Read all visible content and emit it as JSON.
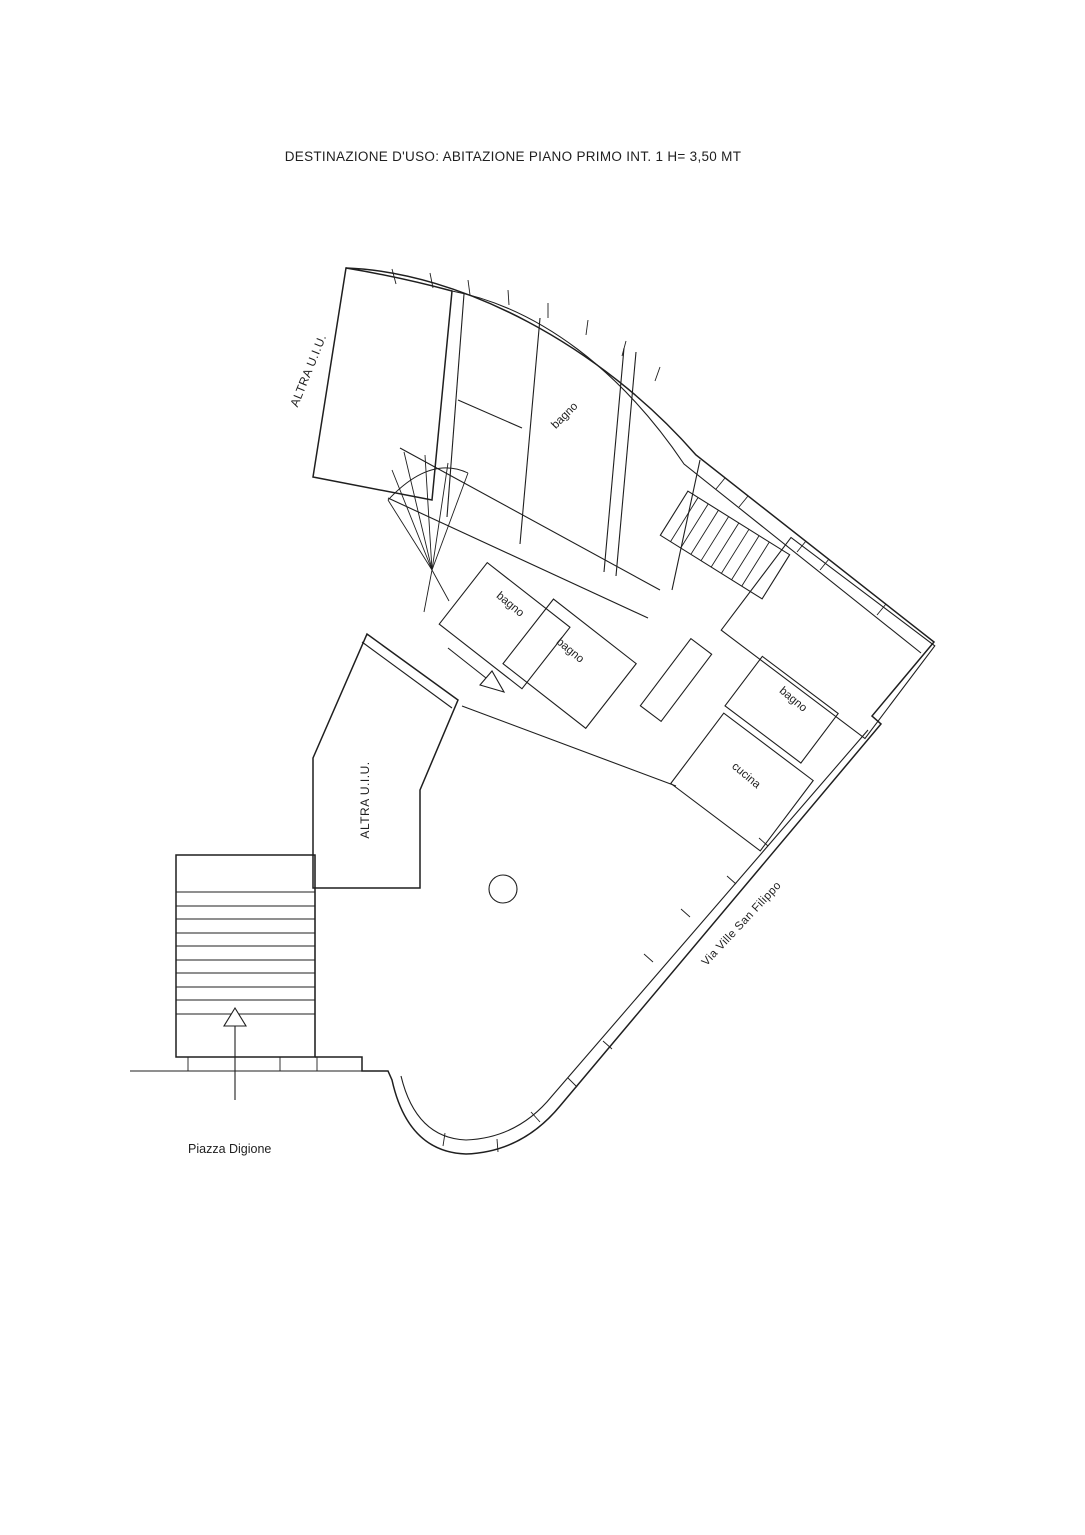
{
  "document": {
    "title": "DESTINAZIONE D'USO: ABITAZIONE PIANO PRIMO INT. 1 H= 3,50 MT",
    "type_note": "floor plan drawing",
    "ink_color": "#1f1f1f",
    "background": "#ffffff"
  },
  "plan": {
    "other_units": [
      {
        "label": "ALTRA U.I.U.",
        "position": "upper-left"
      },
      {
        "label": "ALTRA U.I.U.",
        "position": "lower-left"
      }
    ],
    "rooms": [
      {
        "label": "bagno",
        "position": "upper-wing"
      },
      {
        "label": "bagno",
        "position": "middle-left"
      },
      {
        "label": "bagno",
        "position": "middle-right"
      },
      {
        "label": "bagno",
        "position": "right-wing"
      },
      {
        "label": "cucina",
        "position": "right-wing-lower"
      }
    ],
    "streets": {
      "via": {
        "label": "Via Ville San Filippo"
      },
      "piazza": {
        "label": "Piazza Digione"
      }
    }
  }
}
